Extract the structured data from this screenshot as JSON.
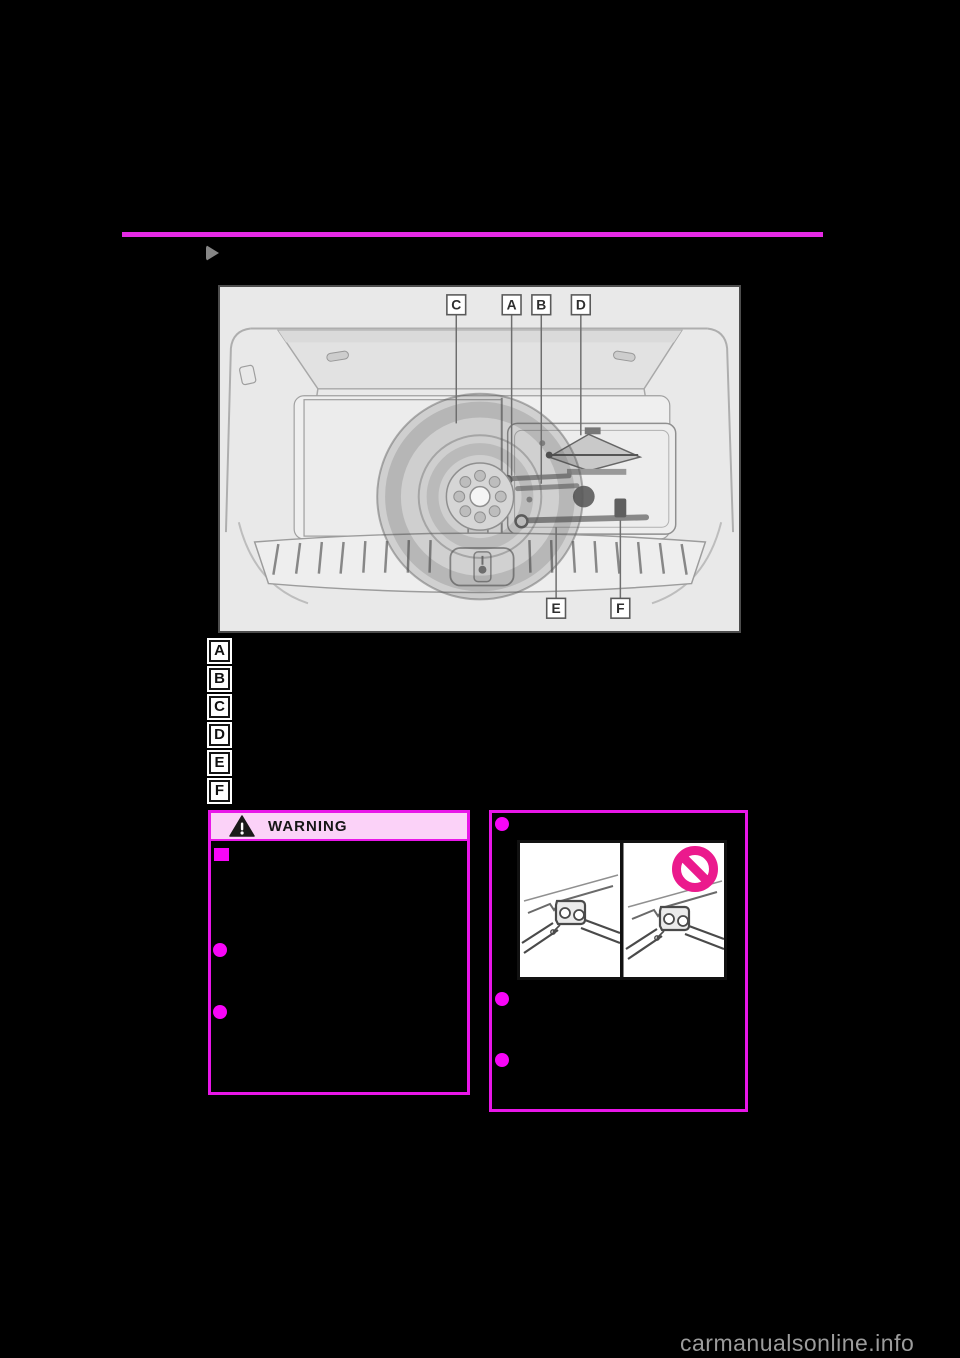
{
  "page": {
    "watermark": "carmanualsonline.info"
  },
  "diagram": {
    "callouts_top": [
      "C",
      "A",
      "B",
      "D"
    ],
    "callouts_bottom": [
      "E",
      "F"
    ]
  },
  "legend": {
    "items": [
      {
        "letter": "A"
      },
      {
        "letter": "B"
      },
      {
        "letter": "C"
      },
      {
        "letter": "D"
      },
      {
        "letter": "E"
      },
      {
        "letter": "F"
      }
    ]
  },
  "warning_box": {
    "title": "WARNING",
    "bullet_markers": [
      "square",
      "circle",
      "circle"
    ]
  },
  "info_box": {
    "bullet_markers": [
      "circle",
      "circle",
      "circle"
    ],
    "illustration": "jack-placement-correct-vs-incorrect"
  },
  "colors": {
    "magenta_accent": "#e816e8",
    "bullet_magenta": "#f805f8",
    "warning_header_pink": "#fbd2f8",
    "prohibition_pink": "#eb1a8d",
    "diagram_background": "#e9e9e9",
    "watermark_gray": "#9c9c9c",
    "section_marker_gray": "#868686"
  }
}
